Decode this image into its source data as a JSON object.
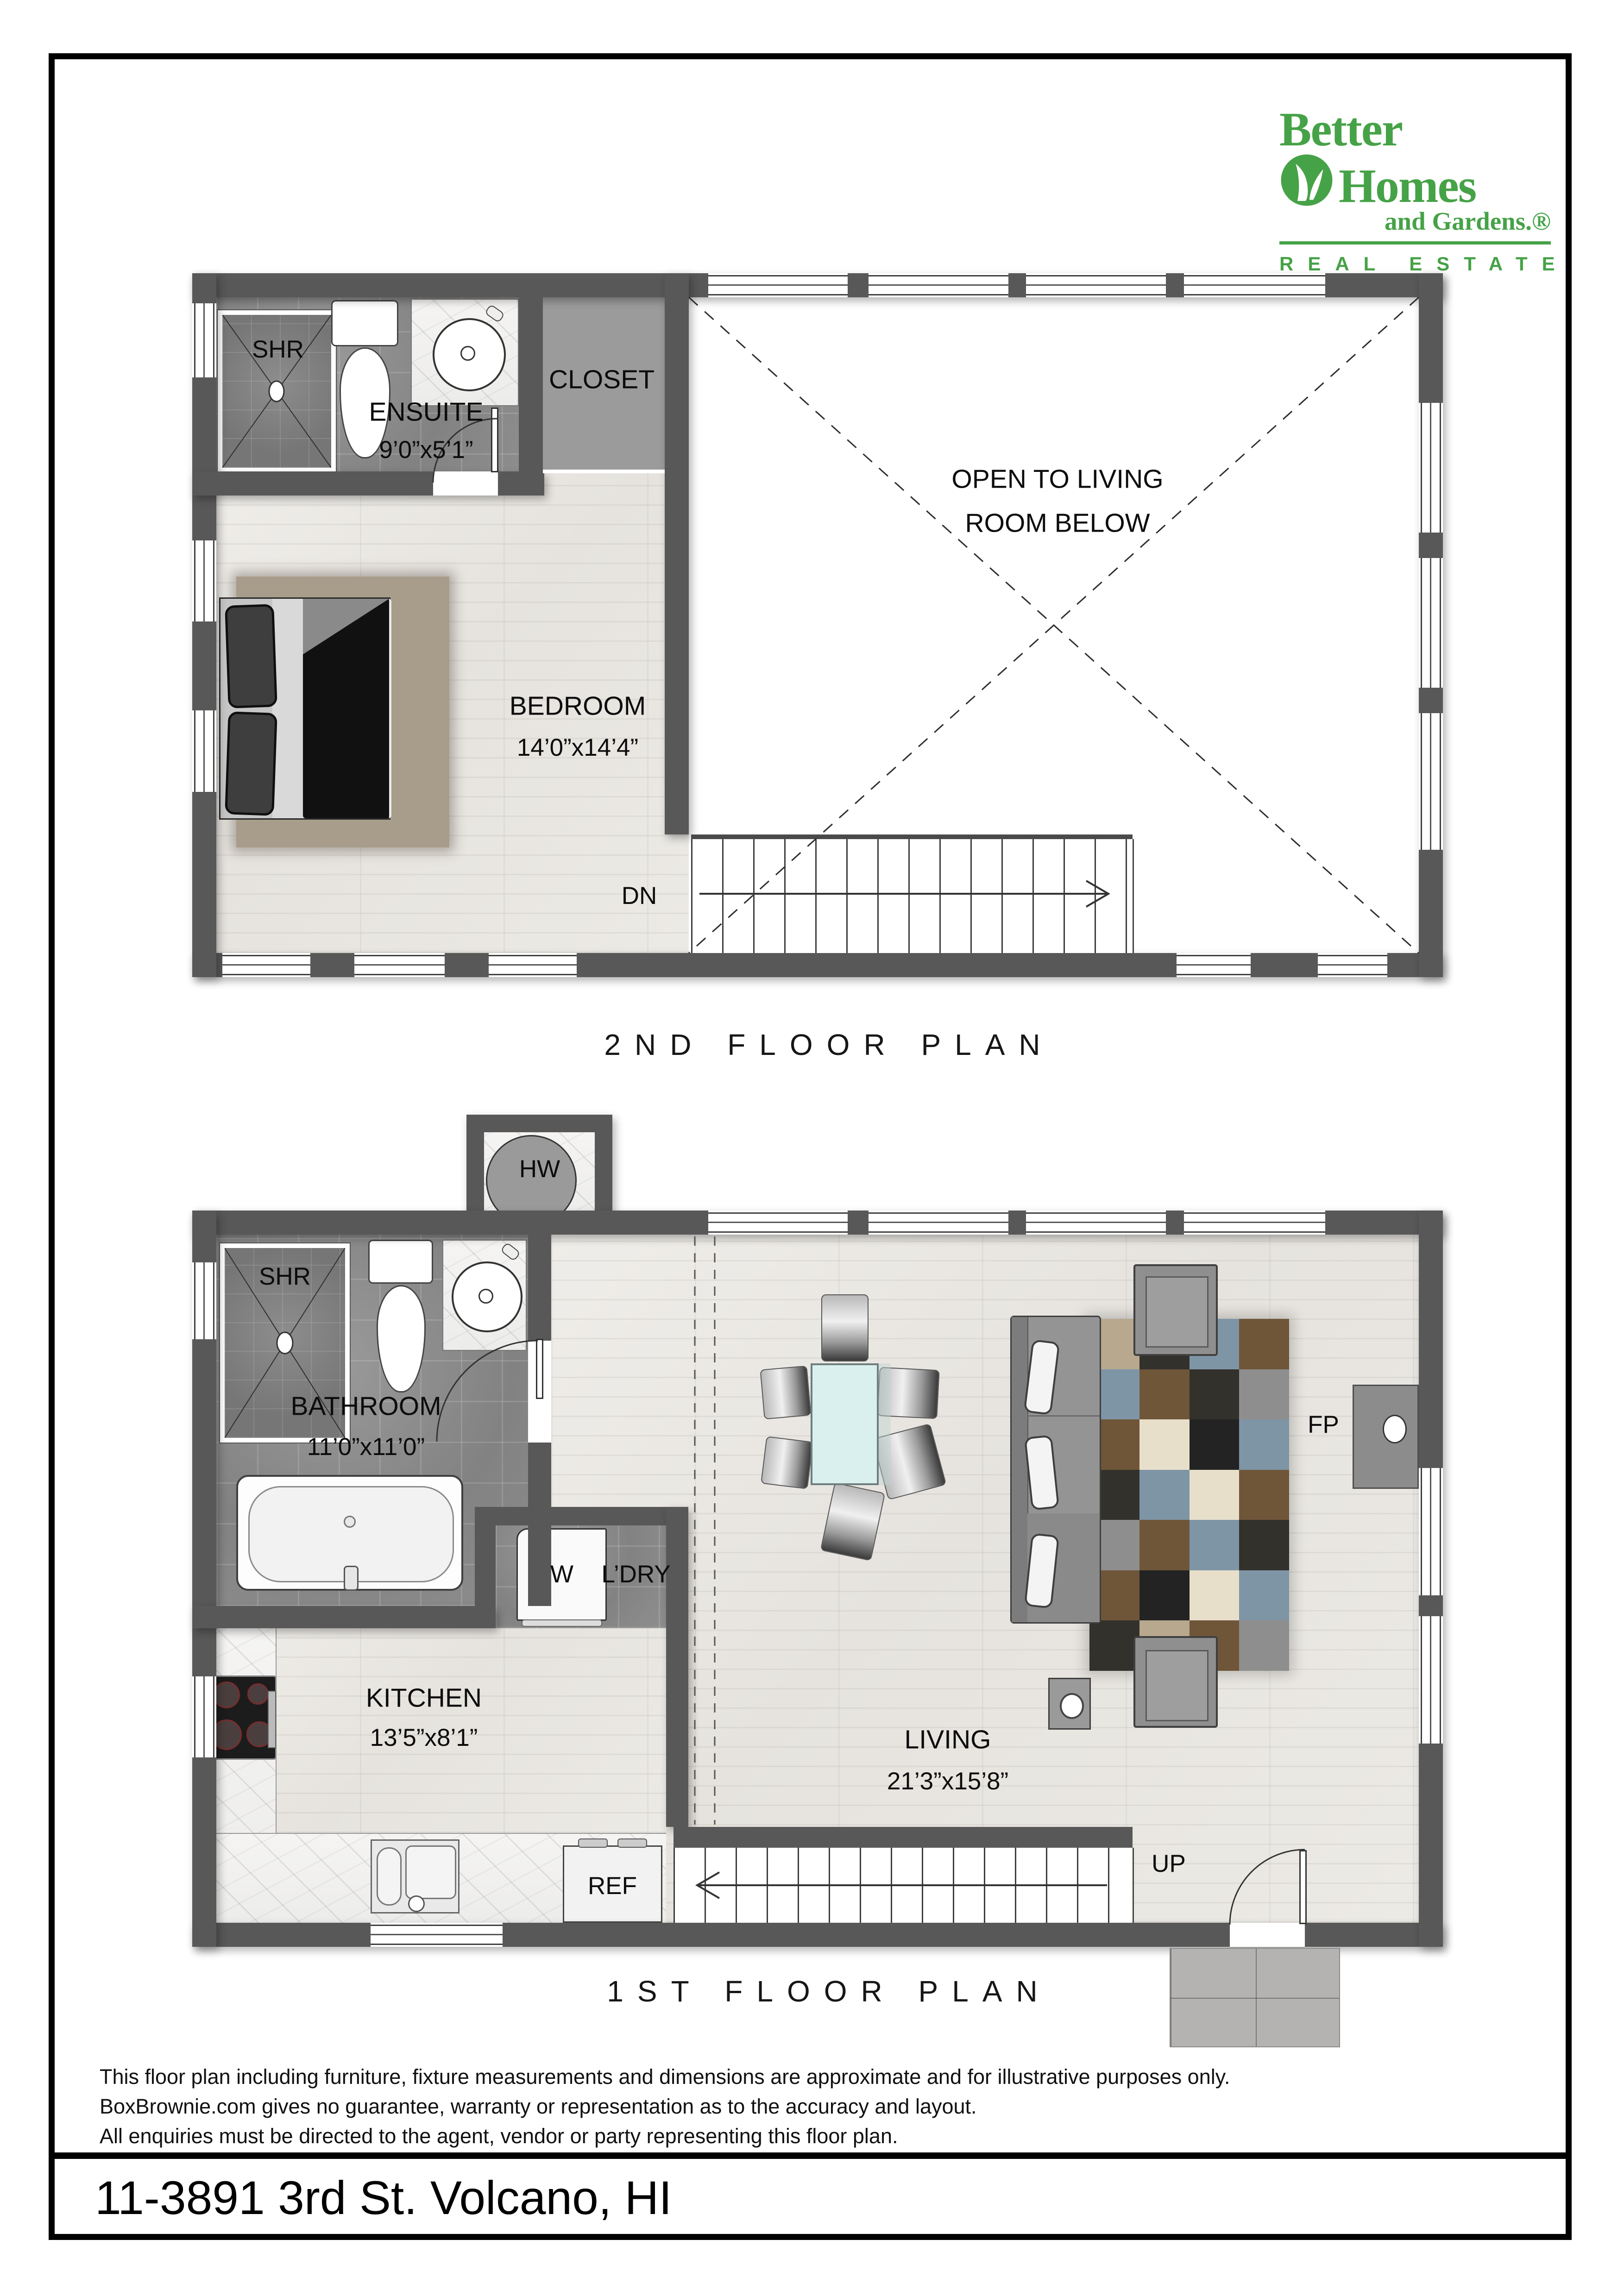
{
  "logo": {
    "line1": "Better",
    "line2": "Homes",
    "line3": "and Gardens",
    "line3_suffix": ".®",
    "tagline": "REAL ESTATE",
    "brand_green": "#46a247",
    "leaf_icon": "leaf-icon"
  },
  "floor2": {
    "title": "2ND FLOOR PLAN",
    "labels": {
      "shr": "SHR",
      "ensuite": "ENSUITE",
      "ensuite_dim": "9’0”x5’1”",
      "closet": "CLOSET",
      "open1": "OPEN TO LIVING",
      "open2": "ROOM BELOW",
      "bedroom": "BEDROOM",
      "bedroom_dim": "14’0”x14’4”",
      "dn": "DN"
    }
  },
  "floor1": {
    "title": "1ST FLOOR PLAN",
    "labels": {
      "hw": "HW",
      "shr": "SHR",
      "bathroom": "BATHROOM",
      "bathroom_dim": "11’0”x11’0”",
      "washer": "W",
      "laundry": "L’DRY",
      "kitchen": "KITCHEN",
      "kitchen_dim": "13’5”x8’1”",
      "ref": "REF",
      "living": "LIVING",
      "living_dim": "21’3”x15’8”",
      "fireplace": "FP",
      "up": "UP"
    },
    "rug": {
      "palette": {
        "charcoal": "#33312c",
        "brown": "#6f5639",
        "blue": "#7e95a6",
        "cream": "#e8dfcb",
        "gray": "#8e8e8e",
        "tan": "#b7a88e",
        "black": "#232323"
      },
      "pattern": [
        [
          "tan",
          "charcoal",
          "blue",
          "brown"
        ],
        [
          "blue",
          "brown",
          "charcoal",
          "gray"
        ],
        [
          "brown",
          "cream",
          "black",
          "blue"
        ],
        [
          "charcoal",
          "blue",
          "cream",
          "brown"
        ],
        [
          "gray",
          "brown",
          "blue",
          "charcoal"
        ],
        [
          "brown",
          "black",
          "cream",
          "blue"
        ],
        [
          "charcoal",
          "tan",
          "brown",
          "gray"
        ]
      ]
    }
  },
  "colors": {
    "wall": "#585858",
    "bedroom_rug": "#a79d8a",
    "duvet": "#111111",
    "sofa": "#949494",
    "glass_table": "#d9f0ee"
  },
  "disclaimer": {
    "line1": "This floor plan including furniture, fixture measurements and dimensions are approximate and for illustrative purposes only.",
    "line2": "BoxBrownie.com gives no guarantee, warranty or representation as to the accuracy and layout.",
    "line3": "All enquiries must be directed to the agent, vendor or party representing this floor plan."
  },
  "address": "11-3891 3rd St. Volcano, HI"
}
